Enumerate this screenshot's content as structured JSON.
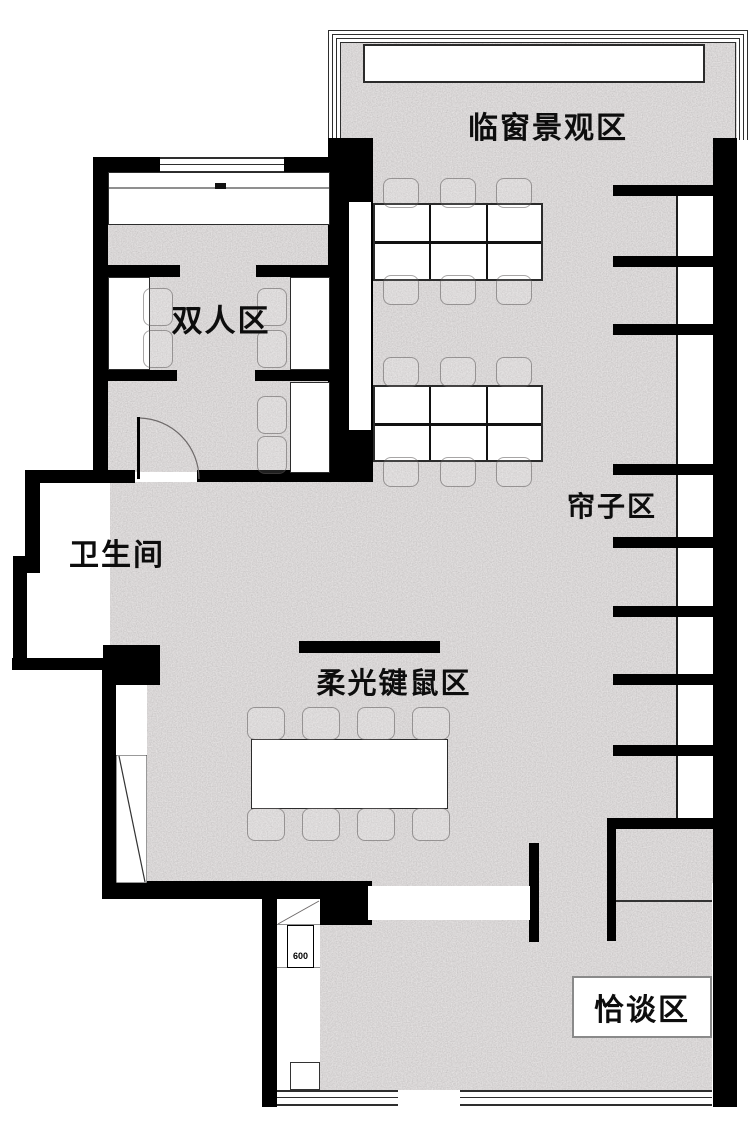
{
  "plan": {
    "labels": {
      "window_view_area": "临窗景观区",
      "double_area": "双人区",
      "bathroom": "卫生间",
      "curtain_area": "帘子区",
      "soft_light_keyboard_mouse_area": "柔光键鼠区",
      "negotiation_area": "恰谈区",
      "dimension_600": "600"
    },
    "colors": {
      "wall_black": "#000000",
      "floor_gray": "#b1acac",
      "furniture_white": "#ffffff",
      "chair_outline": "#8a8585",
      "negotiation_border": "#8a8a8a"
    }
  }
}
